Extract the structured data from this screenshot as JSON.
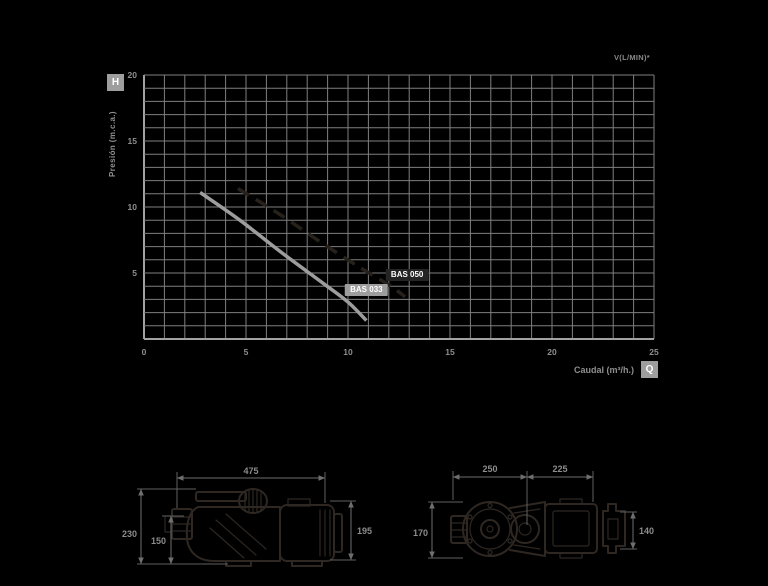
{
  "chart_data": {
    "type": "line",
    "title": "",
    "top_note": "V(L/MIN)*",
    "xlabel": "Caudal (m³/h.)",
    "ylabel": "Presión (m.c.a.)",
    "x_axis_symbol": "Q",
    "y_axis_symbol": "H",
    "xlim": [
      0,
      25
    ],
    "ylim": [
      0,
      20
    ],
    "x_ticks": [
      0,
      5,
      10,
      15,
      20,
      25
    ],
    "y_ticks": [
      5,
      10,
      15,
      20
    ],
    "grid": {
      "step_x": 1,
      "step_y": 1,
      "color": "#7f7f7f",
      "on": true
    },
    "axis_color": "#a2a2a2",
    "tick_label_color": "#8f8f8f",
    "legend_position": "labels-on-curves",
    "series": [
      {
        "name": "BAS 033",
        "line_style": "solid",
        "color": "#9d9d9d",
        "points": [
          [
            2.75,
            11.1
          ],
          [
            4.7,
            9.0
          ],
          [
            6.7,
            6.6
          ],
          [
            8.8,
            4.2
          ],
          [
            10.0,
            2.8
          ],
          [
            10.9,
            1.4
          ]
        ],
        "label_pos": [
          10.9,
          3.7
        ],
        "label_bg": "#9d9d9d",
        "label_text_color": "#ffffff"
      },
      {
        "name": "BAS 050",
        "line_style": "dashed",
        "color": "#27211c",
        "points": [
          [
            4.6,
            11.4
          ],
          [
            6.6,
            9.5
          ],
          [
            8.6,
            7.4
          ],
          [
            10.6,
            5.4
          ],
          [
            12.0,
            4.1
          ],
          [
            12.8,
            3.2
          ]
        ],
        "label_pos": [
          12.9,
          4.85
        ],
        "label_bg": "#242424",
        "label_text_color": "#ffffff"
      }
    ]
  },
  "drawings": {
    "left_pump": {
      "width": "475",
      "height_total": "230",
      "height_inlet": "150",
      "height_right": "195"
    },
    "right_pump": {
      "width_pump": "250",
      "width_motor": "225",
      "height_total": "170",
      "height_bracket": "140"
    }
  }
}
